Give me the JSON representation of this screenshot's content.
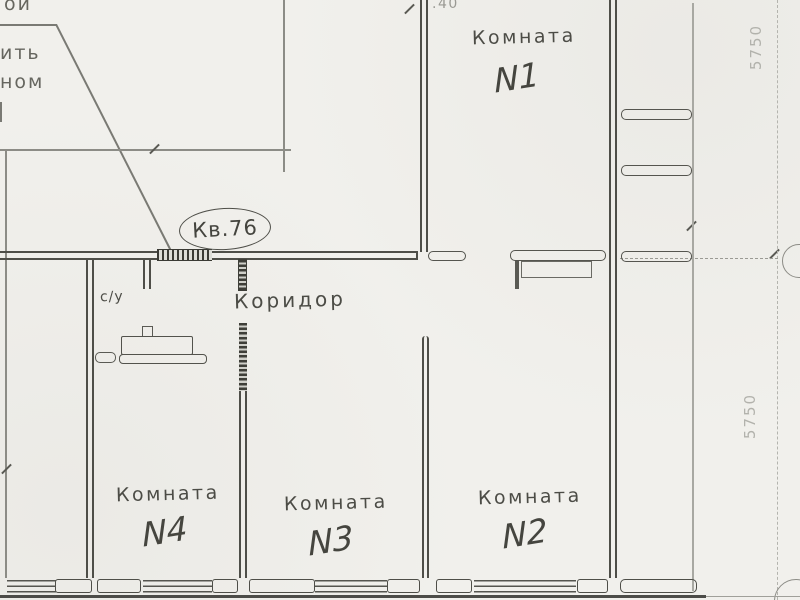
{
  "note": {
    "line1": "ой",
    "line2": "ить",
    "line3": "ном"
  },
  "apartment_label": "Кв.76",
  "rooms": {
    "corridor": "Коридор",
    "bathroom": "с/у",
    "room1": {
      "name": "Комната",
      "number": "N1"
    },
    "room2": {
      "name": "Комната",
      "number": "N2"
    },
    "room3": {
      "name": "Комната",
      "number": "N3"
    },
    "room4": {
      "name": "Комната",
      "number": "N4"
    }
  },
  "dimensions": {
    "top_partial": ".40",
    "right_top": "5750",
    "right_bottom": "5750"
  },
  "colors": {
    "paper": "#f1f0ec",
    "ink": "#4e4e48",
    "faint_ink": "#9a9a94"
  }
}
